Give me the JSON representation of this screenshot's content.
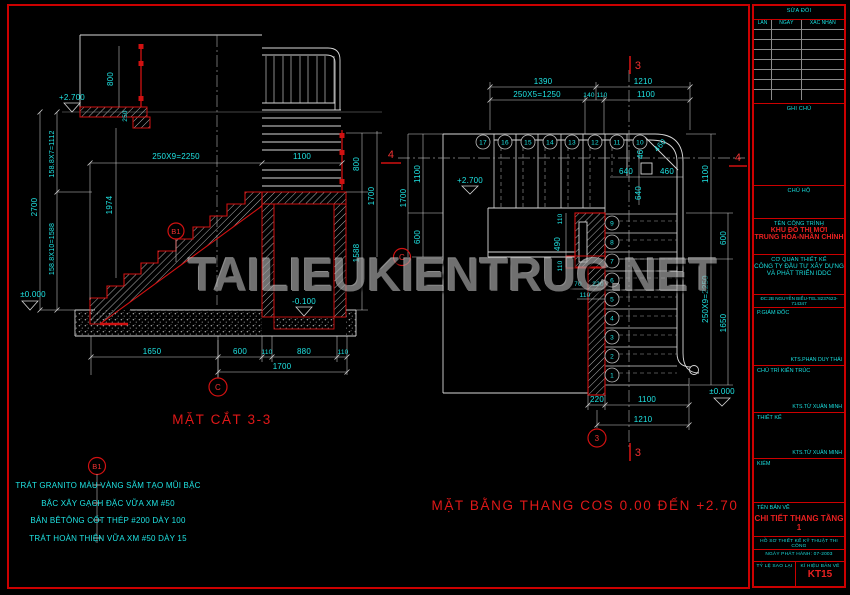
{
  "watermark": "TAILIEUKIENTRUC.NET",
  "colors": {
    "accent_red": "#d11111",
    "dim_cyan": "#1fe3e3",
    "frame_red": "#cc0000"
  },
  "section": {
    "title": "MẶT CẮT 3-3",
    "grid_label": "C",
    "marker_4": "4",
    "detail_ref": "B1",
    "level_top": "+2.700",
    "level_zero": "±0.000",
    "level_minus": "-0.100",
    "dim_rail_left": "800",
    "dim_slab_step": "250",
    "dim_risers_upper": "158.8X7=1112",
    "dim_total_height": "2700",
    "dim_risers_lower": "158.8X10=1588",
    "dim_1974": "1974",
    "dim_run": "250X9=2250",
    "dim_landing": "1100",
    "dim_rail_right": "800",
    "dim_right_1700": "1700",
    "dim_right_1588": "1588",
    "dim_b_1650": "1650",
    "dim_b_600": "600",
    "dim_b_110a": "110",
    "dim_b_880": "880",
    "dim_b_110b": "110",
    "dim_b_1700": "1700"
  },
  "plan": {
    "title": "MẶT BẰNG THANG COS 0.00 ĐẾN +2.70",
    "level_top": "+2.700",
    "level_zero": "±0.000",
    "grid_c": "C",
    "grid_3": "3",
    "marker_3": "3",
    "marker_4": "4",
    "treads_top": [
      "17",
      "16",
      "15",
      "14",
      "13",
      "12",
      "11",
      "10"
    ],
    "treads_right": [
      "9",
      "8",
      "7",
      "6",
      "5",
      "4",
      "3",
      "2",
      "1"
    ],
    "dim_top_1390": "1390",
    "dim_top_1210": "1210",
    "dim_top_1250": "250X5=1250",
    "dim_top_140": "140",
    "dim_top_110": "110",
    "dim_top_1100": "1100",
    "dim_corner_460a": "460",
    "dim_corner_460diag": "460",
    "dim_corner_640a": "640",
    "dim_corner_460b": "460",
    "dim_corner_640b": "640",
    "dim_left_1100": "1100",
    "dim_left_1700": "1700",
    "dim_left_600": "600",
    "dim_right_1100": "1100",
    "dim_right_2250": "250X9=2250",
    "dim_right_600": "600",
    "dim_right_1650": "1650",
    "dim_wall_110a": "110",
    "dim_wall_490": "490",
    "dim_wall_110b": "110",
    "dim_wall_70": "70",
    "dim_wall_220": "220",
    "dim_wall_110c": "110",
    "dim_bot_220": "220",
    "dim_bot_1100": "1100",
    "dim_bot_1210": "1210"
  },
  "notes": {
    "ref": "B1",
    "items": [
      "TRÁT GRANITO MÀU VÀNG SẪM TẠO MŨI BẬC",
      "BẬC XÂY GẠCH ĐẶC VỮA XM #50",
      "BẢN BÊTÔNG CỐT THÉP #200 DÀY 100",
      "TRÁT HOÀN THIỆN VỮA XM #50 DÀY 15"
    ]
  },
  "titleblock": {
    "revision_header": "SỬA ĐỔI",
    "rev_col_1": "LẦN",
    "rev_col_2": "NGÀY",
    "rev_col_3": "XÁC NHẬN",
    "notes_label": "GHI CHÚ",
    "owner_label": "CHỦ HỘ",
    "project_label": "TÊN CÔNG TRÌNH",
    "project_name_1": "KHU ĐÔ THỊ MỚI",
    "project_name_2": "TRUNG HÒA-NHÂN CHÍNH",
    "designer_label": "CƠ QUAN THIẾT KẾ",
    "designer_name_1": "CÔNG TY ĐẦU TƯ XÂY DỰNG",
    "designer_name_2": "VÀ PHÁT TRIỂN IDDC",
    "designer_address": "ĐC:2B NGUYỄN BIỂU-TEL:8237623-714347",
    "deputy_director_label": "P.GIÁM ĐỐC",
    "deputy_director_name": "KTS.PHAN DUY THÁI",
    "chief_architect_label": "CHỦ TRÌ KIẾN TRÚC",
    "chief_architect_name": "KTS.TỪ XUÂN MINH",
    "design_label": "THIẾT KẾ",
    "design_name": "KTS.TỪ XUÂN MINH",
    "check_label": "KIỂM",
    "drawing_title_label": "TÊN BẢN VẼ",
    "drawing_title": "CHI TIẾT THANG TẦNG 1",
    "dossier": "HỒ SƠ THIẾT KẾ KỸ THUẬT THI CÔNG",
    "issue_date": "NGÀY PHÁT HÀNH: 07-2003",
    "scale_label": "TỶ LỆ SAO LẠI",
    "code_label": "KÍ HIỆU BẢN VẼ",
    "drawing_code": "KT15"
  }
}
